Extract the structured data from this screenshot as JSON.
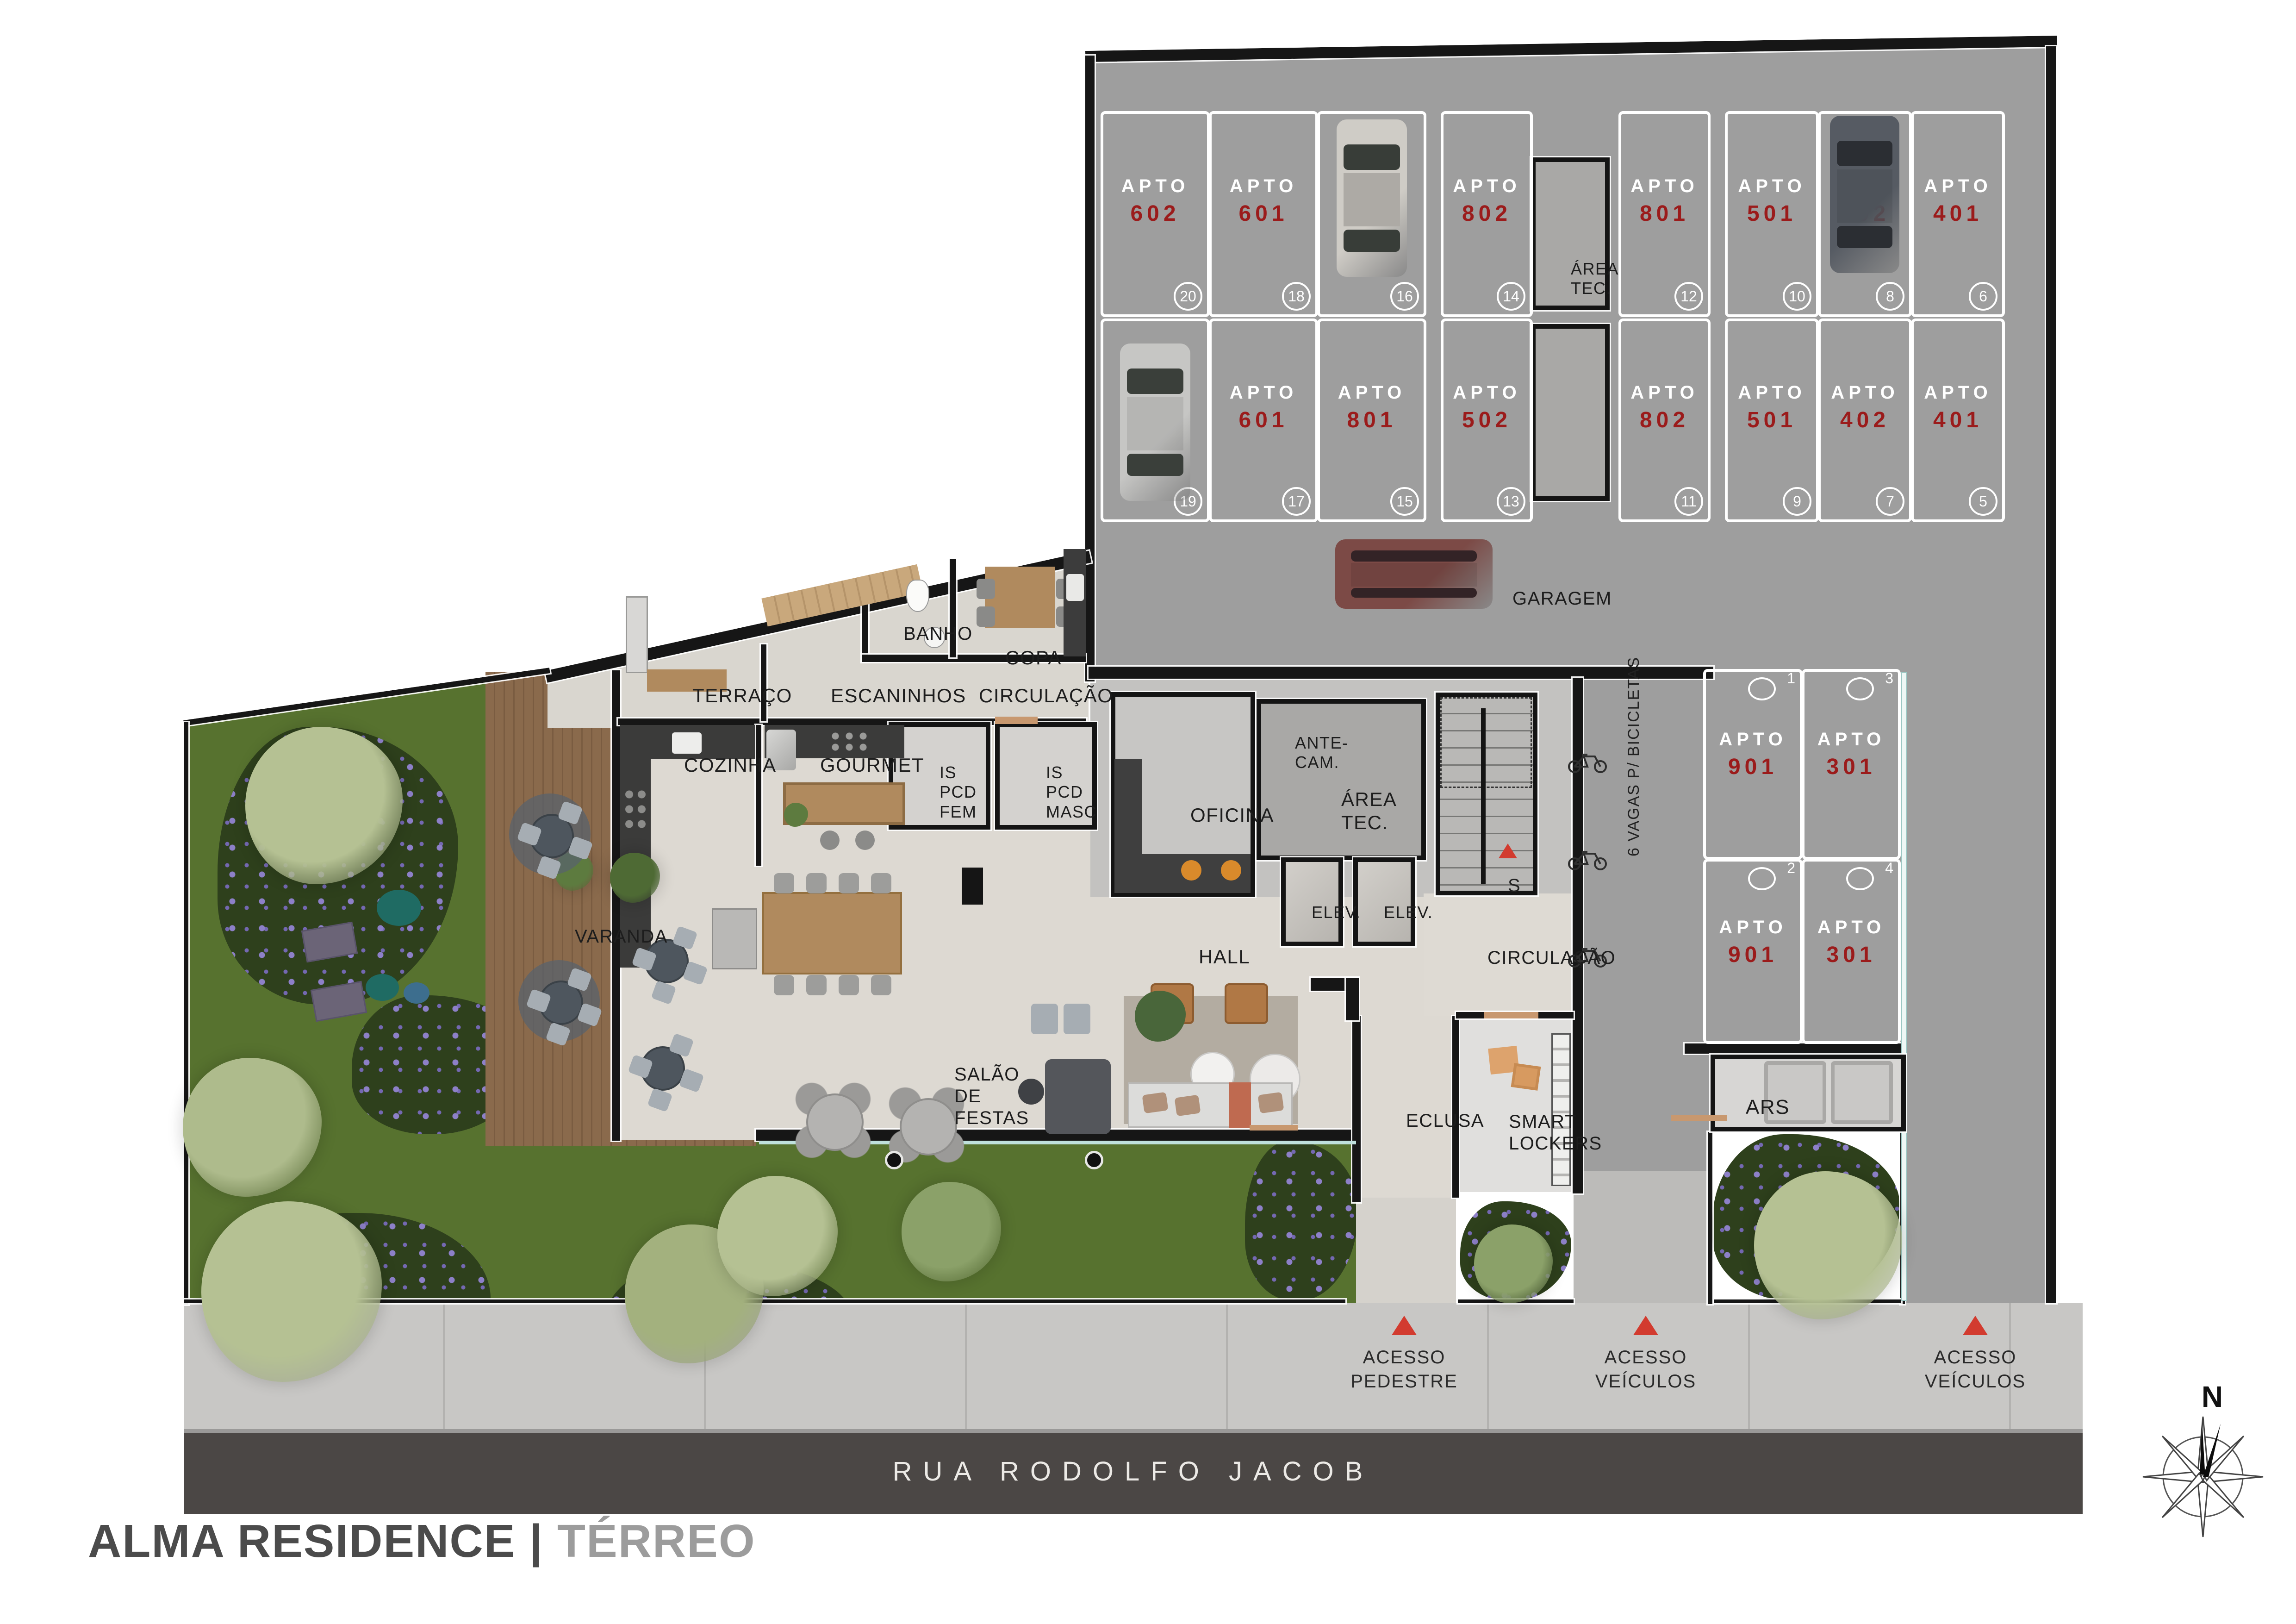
{
  "title": {
    "project": "ALMA RESIDENCE",
    "separator": "|",
    "floor": "TÉRREO"
  },
  "street": {
    "name": "RUA RODOLFO JACOB"
  },
  "compass": {
    "north_label": "N"
  },
  "labels": {
    "apto_word": "APTO",
    "bike_note": "6 VAGAS P/ BICICLETAS",
    "stairs_exit": "S"
  },
  "rooms": [
    {
      "id": "terraco",
      "label": "TERRAÇO"
    },
    {
      "id": "escaninhos",
      "label": "ESCANINHOS"
    },
    {
      "id": "circulacao_1",
      "label": "CIRCULAÇÃO"
    },
    {
      "id": "banho",
      "label": "BANHO"
    },
    {
      "id": "copa",
      "label": "COPA"
    },
    {
      "id": "cozinha",
      "label": "COZINHA"
    },
    {
      "id": "gourmet",
      "label": "GOURMET"
    },
    {
      "id": "is_pcd_fem",
      "label": "IS PCD\nFEM"
    },
    {
      "id": "is_pcd_masc",
      "label": "IS PCD\nMASC"
    },
    {
      "id": "oficina",
      "label": "OFICINA"
    },
    {
      "id": "ante_cam",
      "label": "ANTE-\nCAM."
    },
    {
      "id": "area_tec_interna",
      "label": "ÁREA TEC."
    },
    {
      "id": "elev_1",
      "label": "ELEV."
    },
    {
      "id": "elev_2",
      "label": "ELEV."
    },
    {
      "id": "circulacao_2",
      "label": "CIRCULAÇÃO"
    },
    {
      "id": "hall",
      "label": "HALL"
    },
    {
      "id": "salao_de_festas",
      "label": "SALÃO DE\nFESTAS"
    },
    {
      "id": "eclusa",
      "label": "ECLUSA"
    },
    {
      "id": "smart_lockers",
      "label": "SMART\nLOCKERS"
    },
    {
      "id": "ars",
      "label": "ARS"
    },
    {
      "id": "varanda",
      "label": "VARANDA"
    },
    {
      "id": "garagem",
      "label": "GARAGEM"
    },
    {
      "id": "area_tec_garagem",
      "label": "ÁREA\nTEC."
    }
  ],
  "parking": {
    "row1": [
      {
        "apto": "602",
        "spot": "20"
      },
      {
        "apto": "601",
        "spot": "18"
      },
      {
        "apto": "502",
        "spot": "16"
      },
      {
        "apto": "802",
        "spot": "14"
      },
      {
        "apto": "801",
        "spot": "12"
      },
      {
        "apto": "501",
        "spot": "10"
      },
      {
        "apto": "402",
        "spot": "8"
      },
      {
        "apto": "401",
        "spot": "6"
      }
    ],
    "row2": [
      {
        "apto": "602",
        "spot": "19"
      },
      {
        "apto": "601",
        "spot": "17"
      },
      {
        "apto": "801",
        "spot": "15"
      },
      {
        "apto": "502",
        "spot": "13"
      },
      {
        "apto": "802",
        "spot": "11"
      },
      {
        "apto": "501",
        "spot": "9"
      },
      {
        "apto": "402",
        "spot": "7"
      },
      {
        "apto": "401",
        "spot": "5"
      }
    ],
    "lateral": [
      {
        "apto": "901",
        "spot": "1"
      },
      {
        "apto": "301",
        "spot": "3"
      },
      {
        "apto": "901",
        "spot": "2"
      },
      {
        "apto": "301",
        "spot": "4"
      }
    ]
  },
  "accesses": [
    {
      "label": "ACESSO\nPEDESTRE"
    },
    {
      "label": "ACESSO\nVEÍCULOS"
    },
    {
      "label": "ACESSO\nVEÍCULOS"
    }
  ],
  "icons": {
    "compass_rose": "compass-rose-icon",
    "access_marker": "red-triangle-marker",
    "stairs_marker": "red-triangle-marker",
    "bike": "bicycle-icon"
  },
  "colors": {
    "apto_number": "#9b1b1b",
    "marker_red": "#d23b2f",
    "garage_floor": "#9e9e9e",
    "interior_floor": "#ddd9d2",
    "garden": "#55702f",
    "street": "#4b4745"
  }
}
